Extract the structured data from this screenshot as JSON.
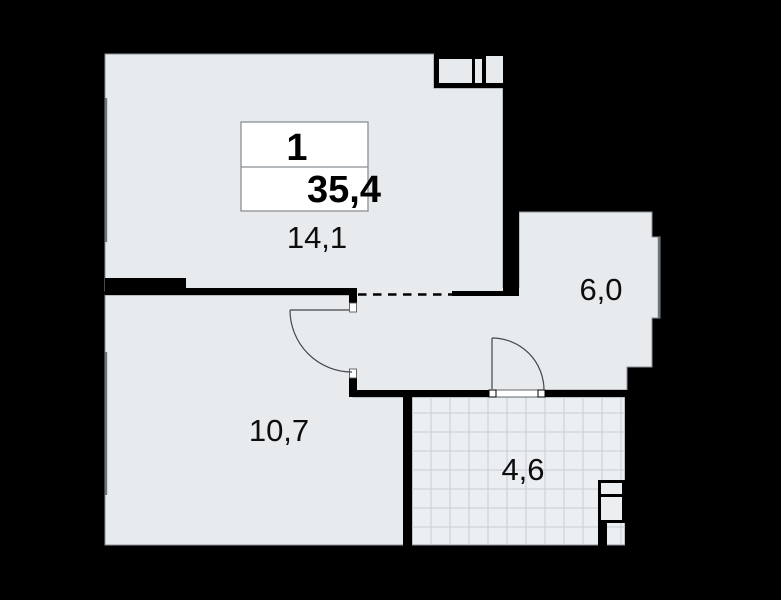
{
  "apartment_plan": {
    "info_card": {
      "rooms_count": "1",
      "total_area": "35,4"
    },
    "rooms": [
      {
        "key": "living_room",
        "area": "14,1"
      },
      {
        "key": "kitchen",
        "area": "6,0"
      },
      {
        "key": "bedroom",
        "area": "10,7"
      },
      {
        "key": "bathroom",
        "area": "4,6"
      }
    ],
    "colors": {
      "background": "#000000",
      "wall": "#000000",
      "floor": "#e8ebee",
      "tile_floor": "#eceff1",
      "tile_grid": "#c9ced3",
      "floor_outline": "#8b9096",
      "window_line": "#6f747a",
      "door_swing": "#43464a",
      "info_card_bg": "#ffffff",
      "info_card_border": "#8a8f95",
      "text": "#0d0d0d"
    }
  }
}
